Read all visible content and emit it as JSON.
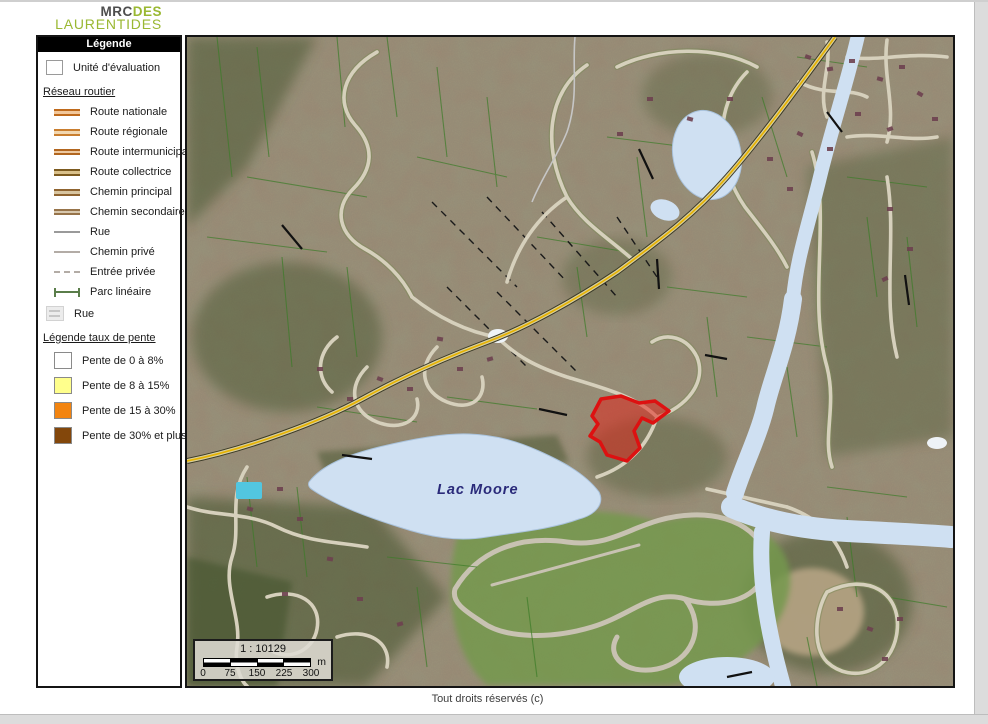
{
  "logo": {
    "mrc": "MRC",
    "des": "DES",
    "laurentides": "LAURENTIDES",
    "green": "#9ab832"
  },
  "legend": {
    "title": "Légende",
    "unit_label": "Unité d'évaluation",
    "section_roads": "Réseau routier",
    "roads": [
      {
        "label": "Route nationale"
      },
      {
        "label": "Route régionale"
      },
      {
        "label": "Route intermunicipale"
      },
      {
        "label": "Route collectrice"
      },
      {
        "label": "Chemin principal"
      },
      {
        "label": "Chemin secondaire"
      },
      {
        "label": "Rue"
      },
      {
        "label": "Chemin privé"
      },
      {
        "label": "Entrée privée"
      },
      {
        "label": "Parc linéaire"
      }
    ],
    "rue_group_label": "Rue",
    "section_slope": "Légende taux de pente",
    "slopes": [
      {
        "label": "Pente de 0 à 8%",
        "color": "#ffffff"
      },
      {
        "label": "Pente de 8 à 15%",
        "color": "#ffff8c"
      },
      {
        "label": "Pente de 15 à 30%",
        "color": "#f28410"
      },
      {
        "label": "Pente de 30% et plus",
        "color": "#83470b"
      }
    ]
  },
  "map": {
    "lake_label": "Lac Moore",
    "highlight_color": "#ff0000",
    "water_color": "#cfe0f2",
    "highway_color": "#e6b200"
  },
  "scalebar": {
    "ratio": "1 : 10129",
    "unit": "m",
    "ticks": [
      "0",
      "75",
      "150",
      "225",
      "300"
    ]
  },
  "footer": {
    "copyright": "Tout droits réservés (c)"
  }
}
